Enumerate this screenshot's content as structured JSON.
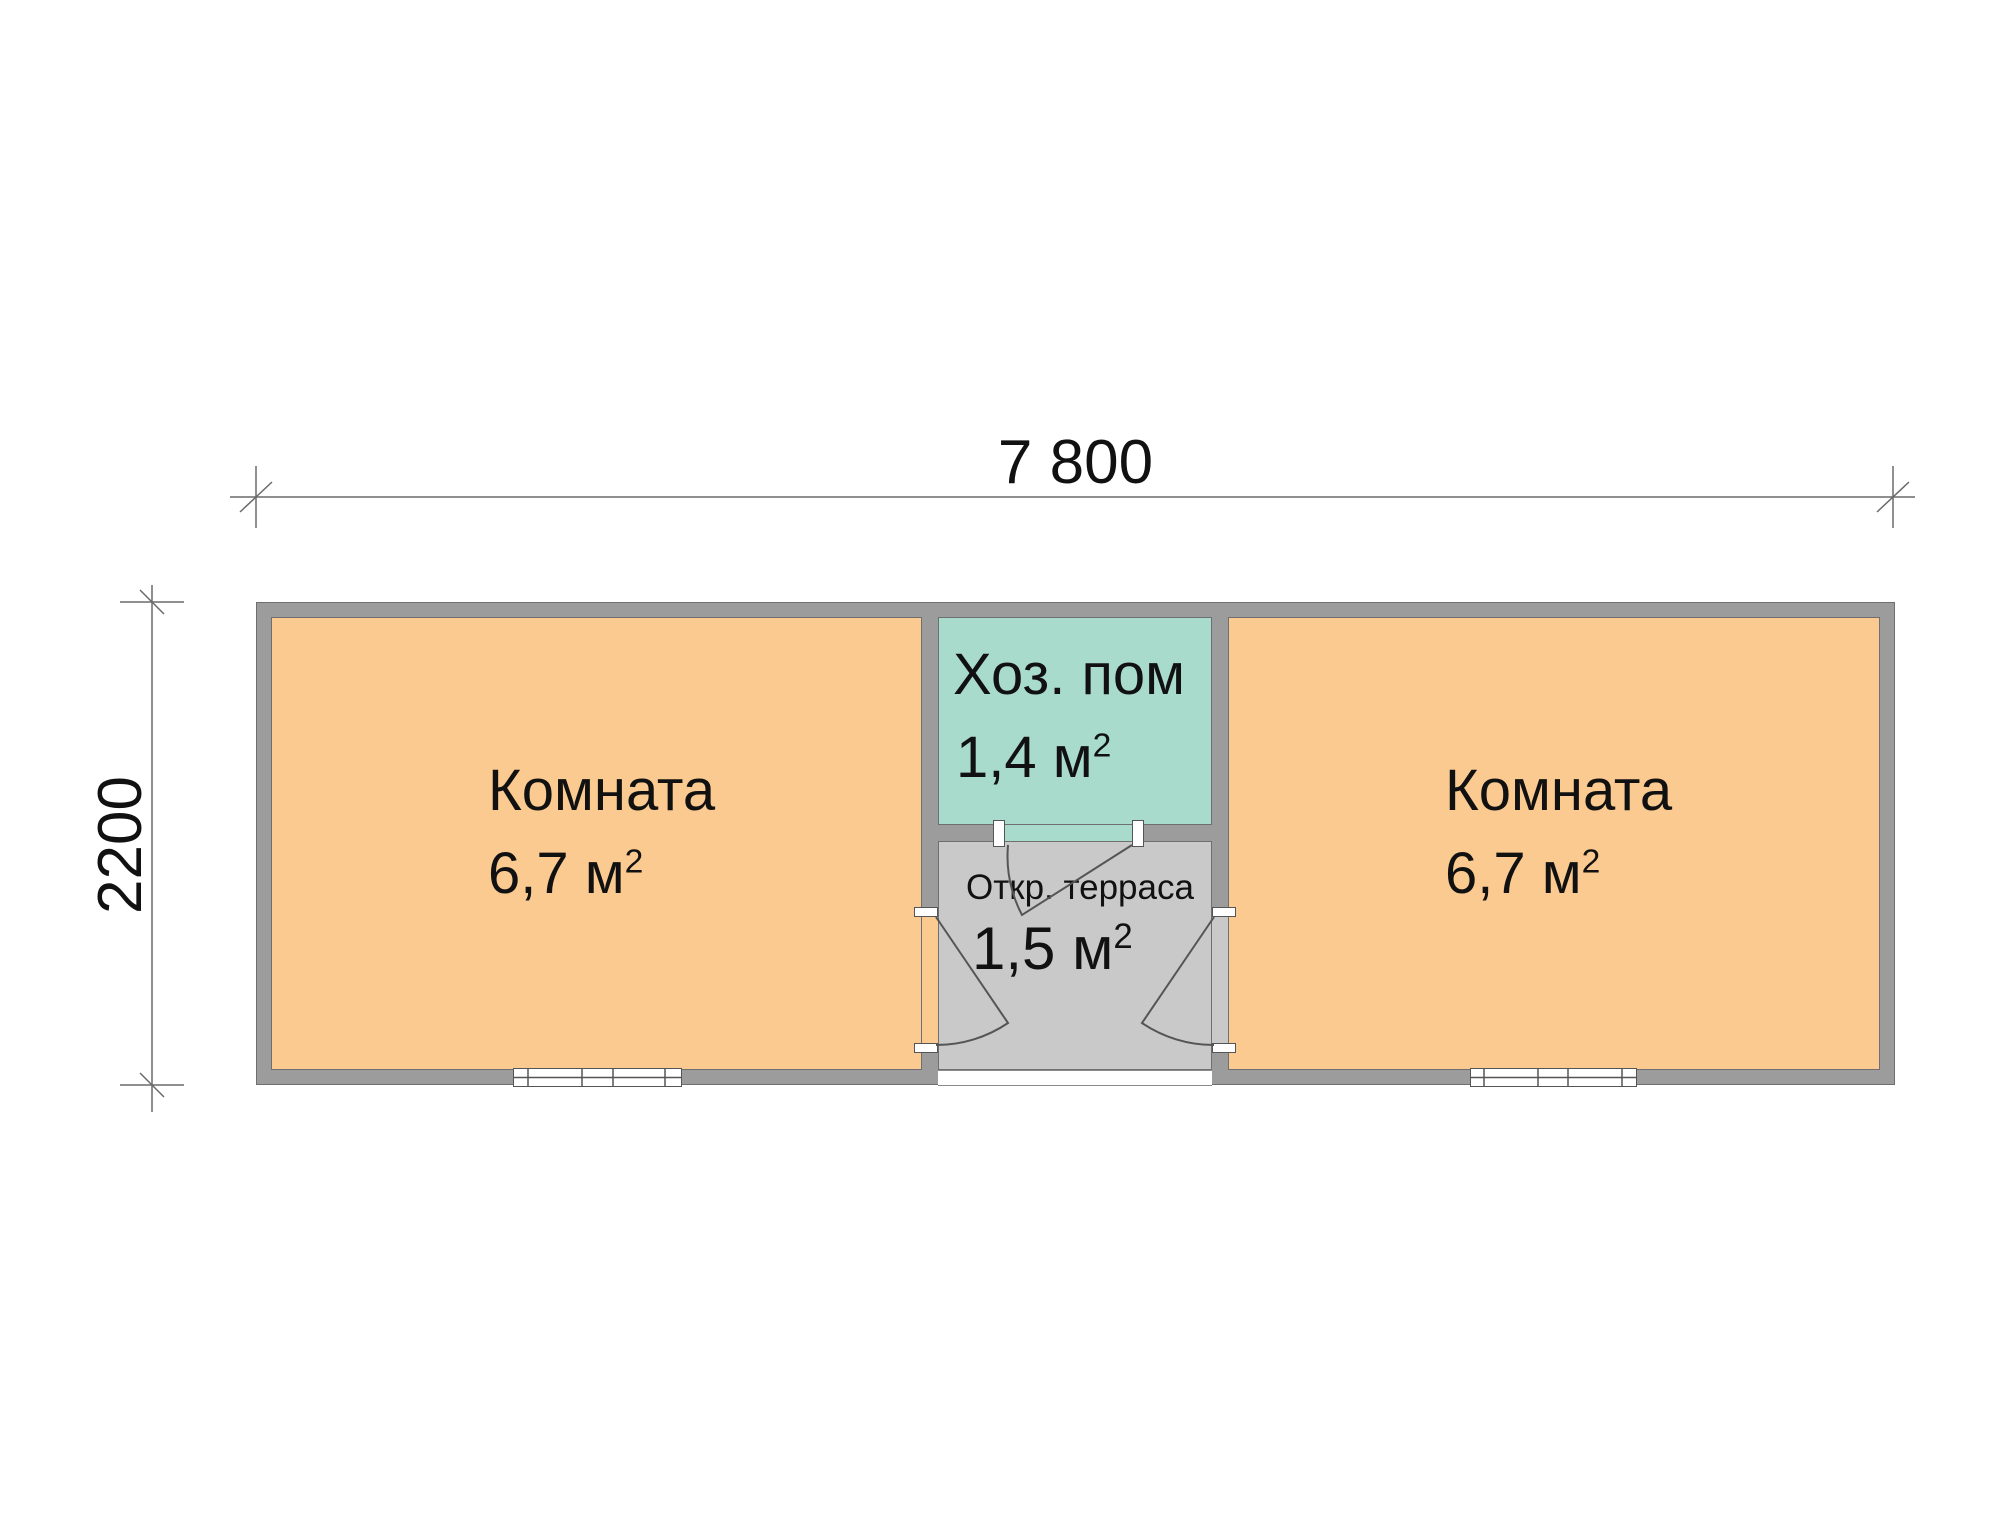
{
  "labels": {
    "dimension_width": "7 800",
    "dimension_height": "2200"
  },
  "rooms": {
    "room_left": {
      "name": "Комната",
      "area": "6,7 м",
      "area_sup": "2"
    },
    "utility": {
      "name": "Хоз. пом",
      "area": "1,4 м",
      "area_sup": "2"
    },
    "terrace": {
      "name": "Откр. терраса",
      "area": "1,5 м",
      "area_sup": "2"
    },
    "room_right": {
      "name": "Комната",
      "area": "6,7 м",
      "area_sup": "2"
    }
  },
  "colors": {
    "room_fill": "#FACA90",
    "utility_fill": "#A9DBCD",
    "terrace_fill": "#C9C9C9",
    "wall_fill": "#9C9C9C",
    "wall_outline": "#6F6F6F",
    "line": "#5A5A5A",
    "text": "#111111",
    "background": "#FFFFFF"
  }
}
